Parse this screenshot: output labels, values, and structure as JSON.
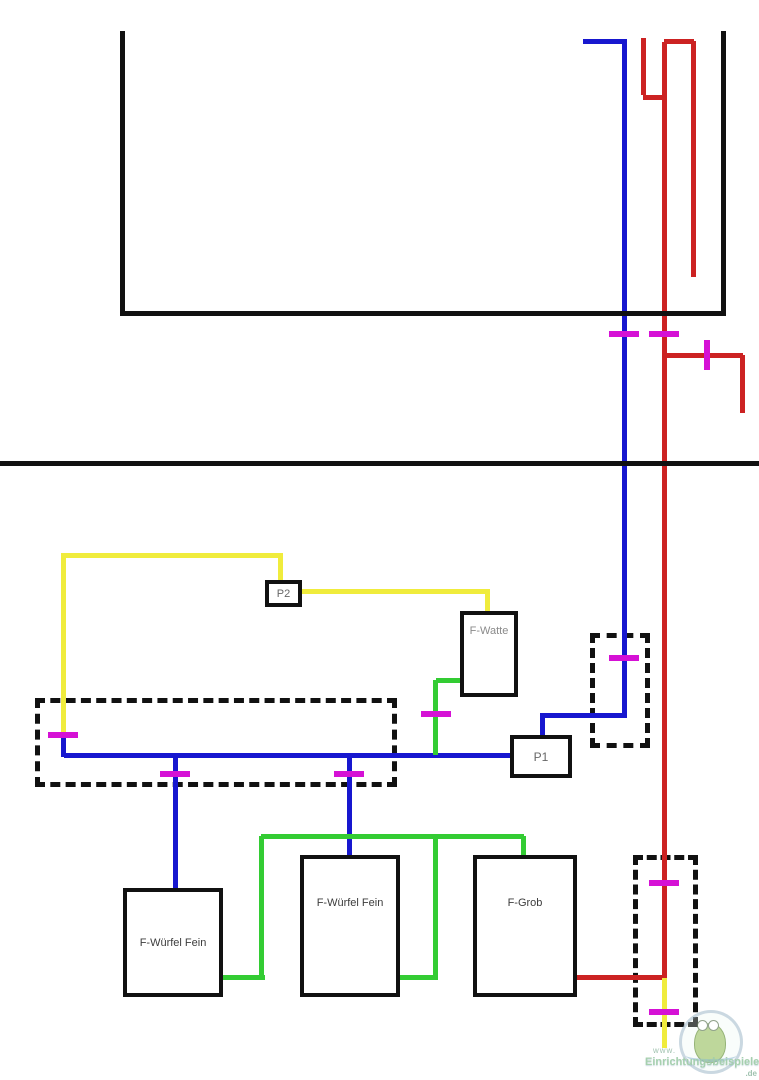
{
  "diagram": {
    "description": "Aquarium filter piping schematic",
    "colors": {
      "black": "#111111",
      "blue": "#1717cf",
      "red": "#cc2222",
      "green": "#33cc33",
      "yellow": "#f0ec3c",
      "magenta": "#d511d5"
    },
    "segments": [
      {
        "color": "black",
        "name": "tank-left-wall",
        "x": 120,
        "y": 31,
        "w": 5,
        "h": 284
      },
      {
        "color": "black",
        "name": "tank-bottom",
        "x": 120,
        "y": 311,
        "w": 606,
        "h": 5
      },
      {
        "color": "black",
        "name": "tank-right-wall",
        "x": 721,
        "y": 31,
        "w": 5,
        "h": 285
      },
      {
        "color": "black",
        "name": "cabinet-divider-line",
        "x": 0,
        "y": 461,
        "w": 759,
        "h": 5
      },
      {
        "color": "blue",
        "name": "intake-top-horizontal",
        "x": 583,
        "y": 39,
        "w": 41,
        "h": 5
      },
      {
        "color": "blue",
        "name": "intake-main-vertical",
        "x": 622,
        "y": 39,
        "w": 5,
        "h": 676
      },
      {
        "color": "blue",
        "name": "intake-elbow-horizontal",
        "x": 542,
        "y": 713,
        "w": 85,
        "h": 5
      },
      {
        "color": "blue",
        "name": "p1-top-riser",
        "x": 540,
        "y": 713,
        "w": 5,
        "h": 24
      },
      {
        "color": "blue",
        "name": "manifold-horizontal",
        "x": 64,
        "y": 753,
        "w": 448,
        "h": 5
      },
      {
        "color": "blue",
        "name": "manifold-left-riser",
        "x": 61,
        "y": 737,
        "w": 5,
        "h": 20
      },
      {
        "color": "blue",
        "name": "branch-to-wuerfel-1",
        "x": 173,
        "y": 755,
        "w": 5,
        "h": 135
      },
      {
        "color": "blue",
        "name": "branch-to-wuerfel-2",
        "x": 347,
        "y": 755,
        "w": 5,
        "h": 102
      },
      {
        "color": "red",
        "name": "return-hook-vertical",
        "x": 641,
        "y": 38,
        "w": 5,
        "h": 57
      },
      {
        "color": "red",
        "name": "return-hook-horizontal",
        "x": 643,
        "y": 95,
        "w": 22,
        "h": 5
      },
      {
        "color": "red",
        "name": "return-main-vertical",
        "x": 662,
        "y": 42,
        "w": 5,
        "h": 936
      },
      {
        "color": "red",
        "name": "return-u-top",
        "x": 664,
        "y": 39,
        "w": 30,
        "h": 5
      },
      {
        "color": "red",
        "name": "return-outlet-in-tank",
        "x": 691,
        "y": 41,
        "w": 5,
        "h": 236
      },
      {
        "color": "red",
        "name": "right-branch-horizontal",
        "x": 665,
        "y": 353,
        "w": 78,
        "h": 5
      },
      {
        "color": "red",
        "name": "right-branch-drop",
        "x": 740,
        "y": 355,
        "w": 5,
        "h": 58
      },
      {
        "color": "red",
        "name": "fgrob-outlet-horizontal",
        "x": 577,
        "y": 975,
        "w": 88,
        "h": 5
      },
      {
        "color": "yellow",
        "name": "pump2-top-horizontal",
        "x": 61,
        "y": 553,
        "w": 222,
        "h": 5
      },
      {
        "color": "yellow",
        "name": "pump2-drop",
        "x": 278,
        "y": 555,
        "w": 5,
        "h": 27
      },
      {
        "color": "yellow",
        "name": "left-down-vertical",
        "x": 61,
        "y": 556,
        "w": 5,
        "h": 181
      },
      {
        "color": "yellow",
        "name": "pump2-to-fwatte-horizontal",
        "x": 302,
        "y": 589,
        "w": 188,
        "h": 5
      },
      {
        "color": "yellow",
        "name": "fwatte-drop",
        "x": 485,
        "y": 591,
        "w": 5,
        "h": 22
      },
      {
        "color": "yellow",
        "name": "bottom-drain-vertical",
        "x": 662,
        "y": 978,
        "w": 5,
        "h": 70
      },
      {
        "color": "green",
        "name": "fwatte-exit-horizontal",
        "x": 436,
        "y": 678,
        "w": 26,
        "h": 5
      },
      {
        "color": "green",
        "name": "fwatte-down-vertical",
        "x": 433,
        "y": 680,
        "w": 5,
        "h": 75
      },
      {
        "color": "green",
        "name": "wuerfel1-out-horizontal",
        "x": 223,
        "y": 975,
        "w": 42,
        "h": 5
      },
      {
        "color": "green",
        "name": "wuerfel1-riser",
        "x": 259,
        "y": 836,
        "w": 5,
        "h": 142
      },
      {
        "color": "green",
        "name": "collector-top-horizontal",
        "x": 261,
        "y": 834,
        "w": 263,
        "h": 5
      },
      {
        "color": "green",
        "name": "drop-into-fgrob",
        "x": 521,
        "y": 836,
        "w": 5,
        "h": 21
      },
      {
        "color": "green",
        "name": "wuerfel2-out-horizontal",
        "x": 400,
        "y": 975,
        "w": 38,
        "h": 5
      },
      {
        "color": "green",
        "name": "wuerfel2-riser",
        "x": 433,
        "y": 836,
        "w": 5,
        "h": 141
      }
    ],
    "valves": [
      {
        "cx": 624,
        "cy": 334,
        "orient": "h"
      },
      {
        "cx": 664,
        "cy": 334,
        "orient": "h"
      },
      {
        "cx": 707,
        "cy": 355,
        "orient": "v"
      },
      {
        "cx": 624,
        "cy": 658,
        "orient": "h"
      },
      {
        "cx": 436,
        "cy": 714,
        "orient": "h"
      },
      {
        "cx": 63,
        "cy": 735,
        "orient": "h"
      },
      {
        "cx": 175,
        "cy": 774,
        "orient": "h"
      },
      {
        "cx": 349,
        "cy": 774,
        "orient": "h"
      },
      {
        "cx": 664,
        "cy": 883,
        "orient": "h"
      },
      {
        "cx": 664,
        "cy": 1012,
        "orient": "h"
      }
    ],
    "boxes": [
      {
        "id": "p2",
        "label": "P2",
        "x": 265,
        "y": 580,
        "w": 37,
        "h": 27,
        "label_color": "#666666",
        "label_size": 11,
        "valign": "center",
        "top_pad": 0
      },
      {
        "id": "f-watte",
        "label": "F-Watte",
        "x": 460,
        "y": 611,
        "w": 58,
        "h": 86,
        "label_color": "#8a8a8a",
        "label_size": 11,
        "valign": "top",
        "top_pad": 10
      },
      {
        "id": "p1",
        "label": "P1",
        "x": 510,
        "y": 735,
        "w": 62,
        "h": 43,
        "label_color": "#666666",
        "label_size": 12,
        "valign": "center",
        "top_pad": 0
      },
      {
        "id": "f-wuerfel-fein-1",
        "label": "F-Würfel Fein",
        "x": 123,
        "y": 888,
        "w": 100,
        "h": 109,
        "label_color": "#3c3c3c",
        "label_size": 11,
        "valign": "center",
        "top_pad": 0
      },
      {
        "id": "f-wuerfel-fein-2",
        "label": "F-Würfel Fein",
        "x": 300,
        "y": 855,
        "w": 100,
        "h": 142,
        "label_color": "#3c3c3c",
        "label_size": 11,
        "valign": "top",
        "top_pad": 38
      },
      {
        "id": "f-grob",
        "label": "F-Grob",
        "x": 473,
        "y": 855,
        "w": 104,
        "h": 142,
        "label_color": "#3c3c3c",
        "label_size": 11,
        "valign": "top",
        "top_pad": 38
      }
    ],
    "dashed_boxes": [
      {
        "name": "dashed-zone-manifold",
        "x": 35,
        "y": 698,
        "w": 362,
        "h": 89
      },
      {
        "name": "dashed-zone-intake",
        "x": 590,
        "y": 633,
        "w": 60,
        "h": 115
      },
      {
        "name": "dashed-zone-return",
        "x": 633,
        "y": 855,
        "w": 65,
        "h": 172
      }
    ],
    "watermark": {
      "www": "www.",
      "name": "Einrichtungsbeispiele",
      "de": ".de"
    }
  }
}
